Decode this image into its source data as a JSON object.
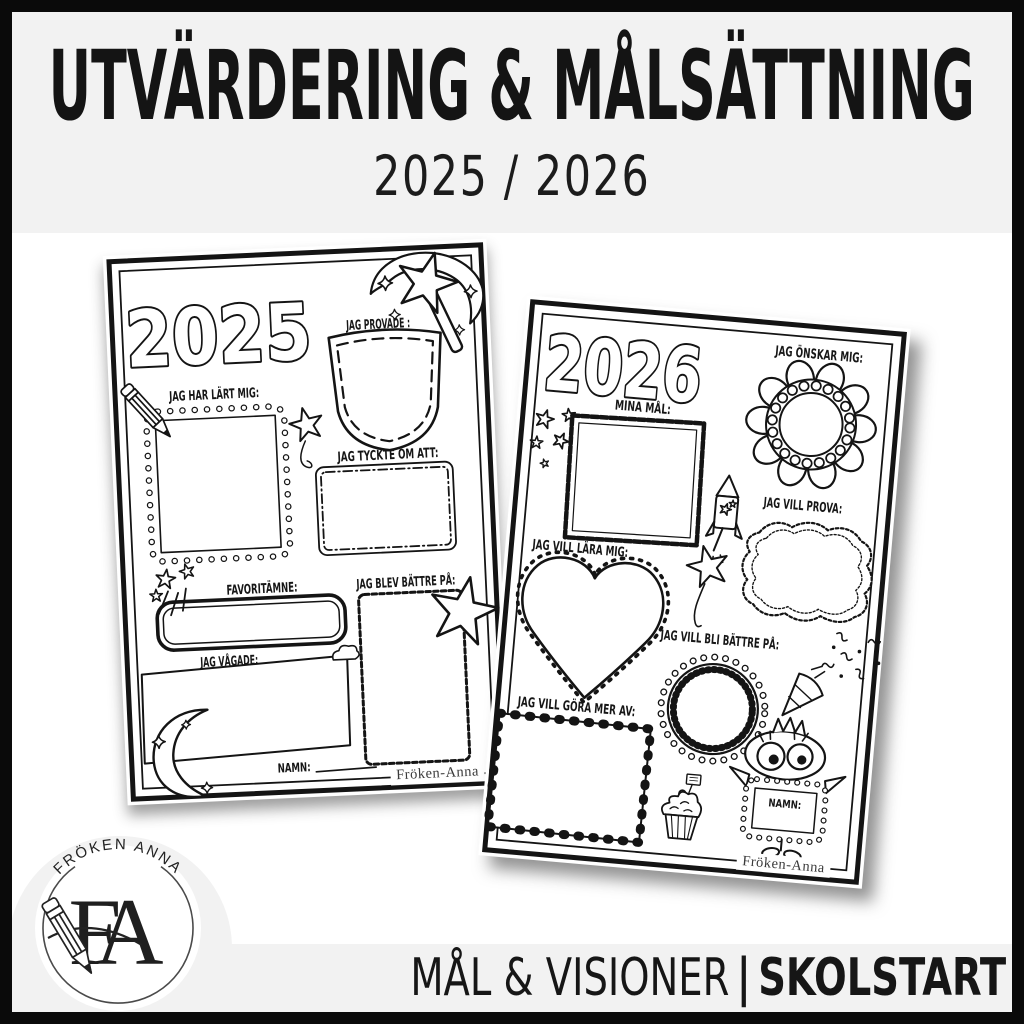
{
  "header": {
    "title": "UTVÄRDERING & MÅLSÄTTNING",
    "years": "2025 / 2026"
  },
  "w2025": {
    "year": "2025",
    "labels": {
      "provade": "JAG PROVADE :",
      "lart": "JAG HAR LÄRT MIG:",
      "tyckte": "JAG TYCKTE OM ATT:",
      "favoritamne": "FAVORITÄMNE:",
      "blev": "JAG BLEV BÄTTRE PÅ:",
      "vagade": "JAG VÅGADE:",
      "namn": "NAMN:"
    },
    "credit": "Fröken-Anna",
    "doodles": [
      "magic-wand",
      "sparkle-diamonds",
      "pocket",
      "pencil",
      "star-on-string",
      "shooting-stars",
      "big-star",
      "cloud",
      "crescent-moon"
    ]
  },
  "w2026": {
    "year": "2026",
    "labels": {
      "onskar": "JAG ÖNSKAR MIG:",
      "mina_mal": "MINA MÅL:",
      "prova": "JAG VILL PROVA:",
      "lara": "JAG VILL LÄRA MIG:",
      "bli_battre": "JAG VILL BLI BÄTTRE PÅ:",
      "gora_mer": "JAG VILL GÖRA MER AV:",
      "namn": "NAMN:"
    },
    "credit": "Fröken-Anna",
    "doodles": [
      "flower-wreath",
      "stars-cluster",
      "firework-rocket",
      "ornate-plaque",
      "stitched-heart",
      "star-balloon",
      "scalloped-badge",
      "party-popper",
      "confetti",
      "ticked-square",
      "cupcake",
      "googly-eye-monster"
    ]
  },
  "logo": {
    "brand": "FRÖKEN ANNA",
    "monogram": "FA"
  },
  "footer": {
    "series": "MÅL & VISIONER",
    "separator": "|",
    "category": "SKOLSTART"
  },
  "colors": {
    "band": "#f2f2f2",
    "paper": "#ffffff",
    "ink": "#141414",
    "frame": "#0a0a0a"
  }
}
